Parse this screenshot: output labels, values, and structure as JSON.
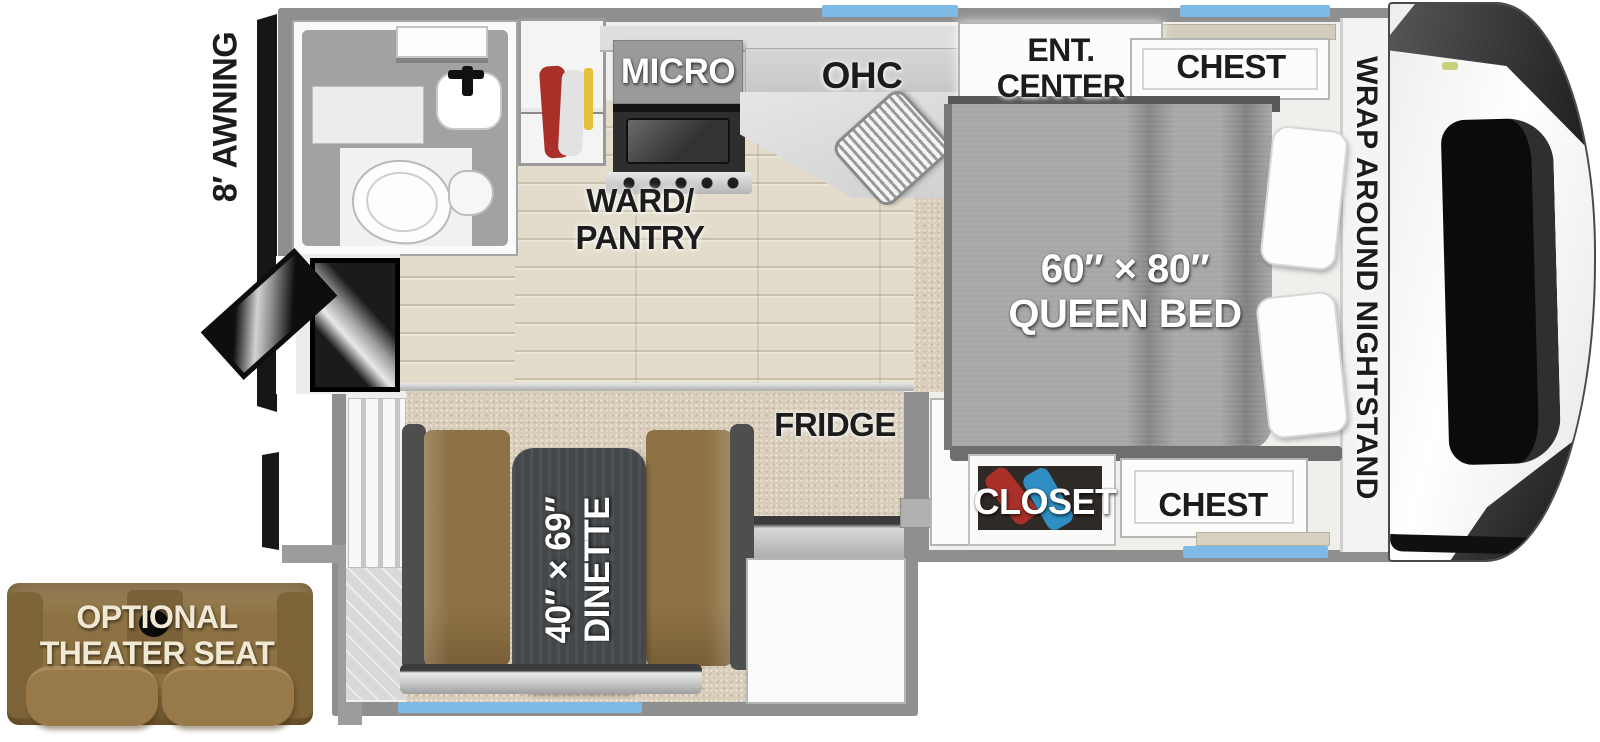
{
  "floorplan": {
    "labels": {
      "awning": "8′ AWNING",
      "micro": "MICRO",
      "ohc": "OHC",
      "ward_pantry": "WARD/\nPANTRY",
      "ent_center": "ENT.\nCENTER",
      "chest_top": "CHEST",
      "wrap_nightstand": "WRAP AROUND NIGHTSTAND",
      "queen_bed": "60″ × 80″\nQUEEN BED",
      "fridge": "FRIDGE",
      "closet": "CLOSET",
      "chest_bottom": "CHEST",
      "dinette": "40″ × 69″\nDINETTE",
      "theater_seat": "OPTIONAL\nTHEATER SEAT"
    },
    "colors": {
      "wall_gray": "#8f8f8f",
      "window_blue": "#7fb9e6",
      "tv_blue": "#2b5cc0",
      "bench_brown": "#8d7245",
      "table_gray": "#45484a",
      "bed_gray": "#a7a7a7",
      "carpet": "#d8ccba",
      "wood_floor": "#e3dccc",
      "clothes_red": "#a83028",
      "clothes_blue": "#2f8fc4",
      "sofa_brown": "#8d7243"
    },
    "fixtures": [
      "bathroom-toilet",
      "bathroom-sink",
      "roof-vent",
      "wardrobe-clothes",
      "range-burners",
      "kitchen-sink",
      "entry-door",
      "entry-steps",
      "queen-bed-pillows",
      "closet-clothes",
      "entry-step-well",
      "front-cap-window",
      "theater-seat-cupholder"
    ]
  }
}
